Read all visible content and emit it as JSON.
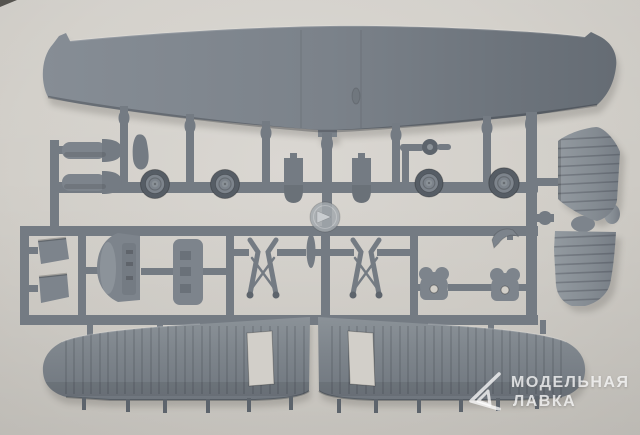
{
  "scene": {
    "alt": "Photograph of a grey injection-moulded plastic model aircraft sprue on a light backdrop"
  },
  "watermark": {
    "line1": "МОДЕЛЬНАЯ",
    "line2": "ЛАВКА",
    "logo": "triangle-logo"
  },
  "colors": {
    "bg_light": "#dad7d2",
    "bg_mid": "#d2cfc9",
    "bg_dark": "#c2bfb9",
    "plastic": "#747b83",
    "plastic_light": "#8a9197",
    "plastic_mid": "#7d848c",
    "plastic_dark": "#5d646c",
    "tire": "#565d65",
    "hub": "#a2a8ad",
    "corner": "#55544f",
    "watermark": "rgba(255,255,255,0.75)"
  },
  "parts": {
    "top_wing": "one-piece upper wing",
    "lower_wing_left": "port lower wing half with ribbed surface and rectangular cutout",
    "lower_wing_right": "starboard lower wing half with ribbed surface and rectangular cutout",
    "stabilizer_fins": "two stabilizer/fin halves joined at centre",
    "main_wheels": "four main wheels with hub detail",
    "fuel_tanks": "two cylindrical tank/fairing parts",
    "teardrop_fairing": "teardrop shaped fairing",
    "hatches": "two rounded hatch panels",
    "tail_wheel": "tail wheel with strut",
    "sprue_hub": "round sprue hub with moulded arrow",
    "cowl_flaps": "two small trapezoid panels",
    "engine_cowling": "curved cowling piece",
    "interior_panel": "flat detail panel with openings",
    "gear_struts": "two M-shaped landing gear struts",
    "small_blade": "small blade part",
    "exhaust": "curved exhaust part",
    "wheel_covers": "two wheel cover parts with centre hole"
  }
}
